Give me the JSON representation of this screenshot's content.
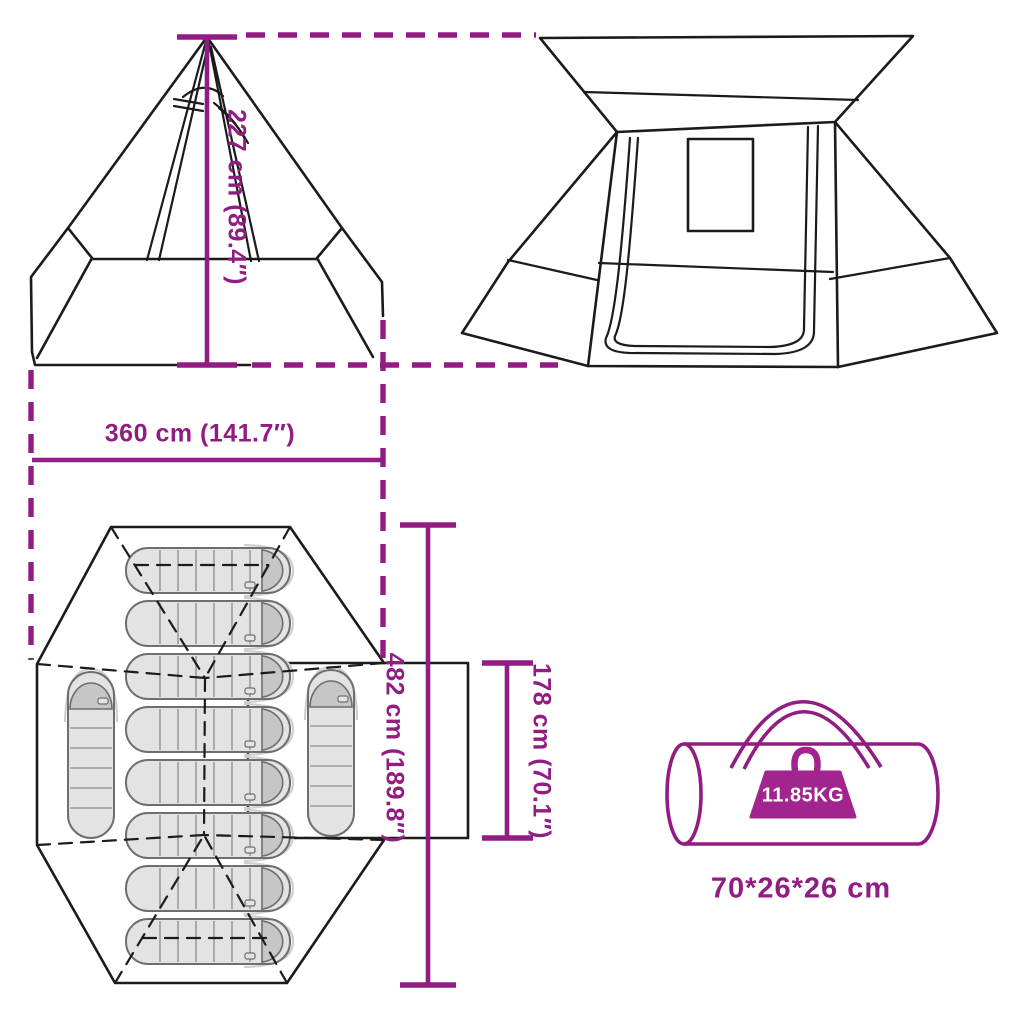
{
  "front_view": {
    "height_label": "227 cm (89.4″)",
    "width_label": "360 cm (141.7″)"
  },
  "floor_plan": {
    "length_label": "482 cm (189.8″)",
    "door_width_label": "178 cm (70.1″)",
    "sleeping_bags_horizontal": 8,
    "sleeping_bags_vertical": 2
  },
  "carry_bag": {
    "weight_label": "11.85KG",
    "size_label": "70*26*26 cm"
  },
  "colors": {
    "accent": "#911C82",
    "weight_fill": "#A2248F",
    "outline": "#1B1B1B",
    "bag_fill": "#E3E3E3",
    "bag_cap": "#C6C6C6"
  }
}
